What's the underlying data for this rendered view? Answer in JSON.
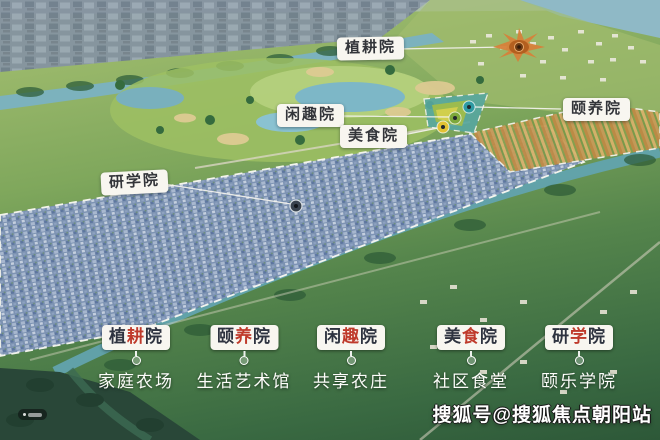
{
  "callouts": [
    {
      "label": "植耕院",
      "marker_icon": "starburst-marker",
      "marker_color": "#d6813a"
    },
    {
      "label": "闲趣院",
      "marker_icon": "green-dot-marker",
      "marker_color": "#7da83b"
    },
    {
      "label": "美食院",
      "marker_icon": "yellow-dot-marker",
      "marker_color": "#e2c233"
    },
    {
      "label": "颐养院",
      "marker_icon": "teal-dot-marker",
      "marker_color": "#2f9aa3"
    },
    {
      "label": "研学院",
      "marker_icon": "dark-dot-marker",
      "marker_color": "#3c4650"
    }
  ],
  "legend": [
    {
      "chars": [
        "植",
        "耕",
        "院"
      ],
      "subtitle": "家庭农场"
    },
    {
      "chars": [
        "颐",
        "养",
        "院"
      ],
      "subtitle": "生活艺术馆"
    },
    {
      "chars": [
        "闲",
        "趣",
        "院"
      ],
      "subtitle": "共享农庄"
    },
    {
      "chars": [
        "美",
        "食",
        "院"
      ],
      "subtitle": "社区食堂"
    },
    {
      "chars": [
        "研",
        "学",
        "院"
      ],
      "subtitle": "颐乐学院"
    }
  ],
  "watermark": {
    "text": "搜狐号@搜狐焦点朝阳站"
  },
  "colors": {
    "accent_red": "#bf3a2b",
    "label_text": "#2e3340",
    "label_bg": "#f8f6f0",
    "leader_line": "#f4f3ee",
    "site_boundary_dash": "#f7f7f1",
    "site_fill": "#7e93b6"
  }
}
